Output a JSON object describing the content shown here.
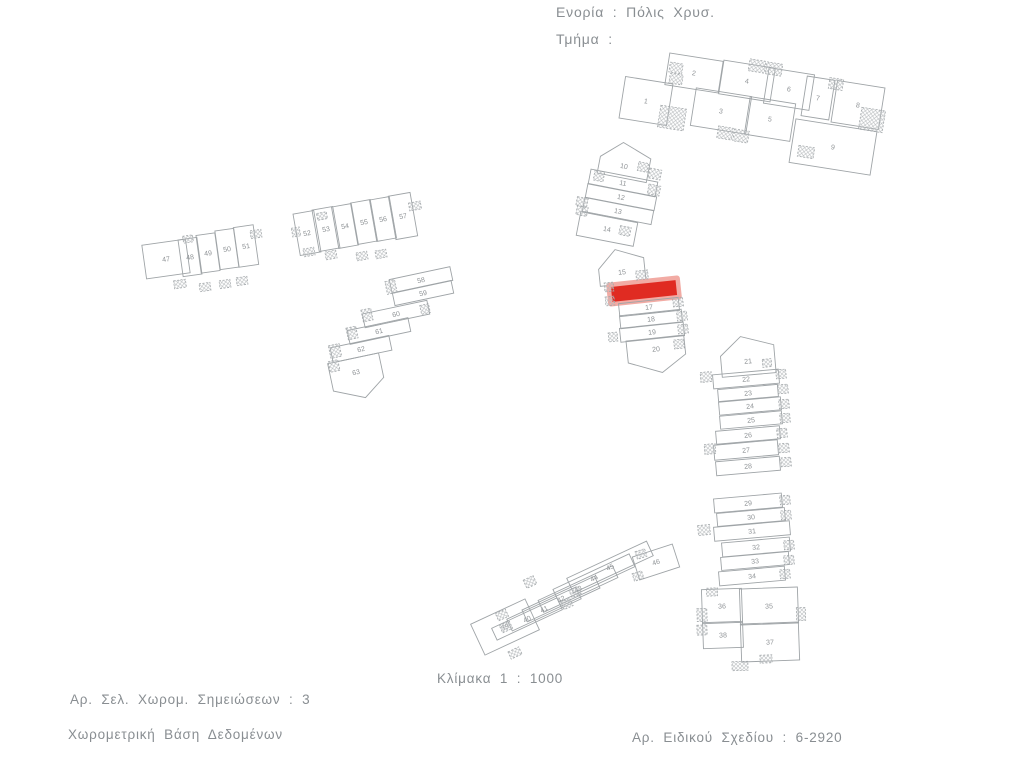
{
  "header": {
    "parish": "Ενορία : Πόλις Χρυσ.",
    "section": "Τμήμα :"
  },
  "footer": {
    "scale": "Κλίμακα 1 : 1000",
    "notes_pages": "Αρ. Σελ. Χωρομ. Σημειώσεων : 3",
    "database": "Χωρομετρική Βάση Δεδομένων",
    "plan_number": "Αρ. Ειδικού Σχεδίου : 6-2920"
  },
  "map": {
    "line_color": "#9fa4a7",
    "label_color": "#8f9396",
    "hatch_color": "#b7bbbd",
    "highlight_color": "#e02b22",
    "highlight_halo": "#f2aba4",
    "clusters": [
      {
        "name": "block-1-9",
        "parcels": [
          {
            "label": "1",
            "cx": 646,
            "cy": 101,
            "w": 48,
            "h": 42,
            "rot": 9
          },
          {
            "label": "2",
            "cx": 694,
            "cy": 73,
            "w": 54,
            "h": 32,
            "rot": 9
          },
          {
            "label": "3",
            "cx": 721,
            "cy": 111,
            "w": 56,
            "h": 38,
            "rot": 9
          },
          {
            "label": "4",
            "cx": 747,
            "cy": 81,
            "w": 52,
            "h": 34,
            "rot": 9
          },
          {
            "label": "5",
            "cx": 770,
            "cy": 119,
            "w": 46,
            "h": 38,
            "rot": 9
          },
          {
            "label": "6",
            "cx": 789,
            "cy": 89,
            "w": 46,
            "h": 36,
            "rot": 9
          },
          {
            "label": "7",
            "cx": 818,
            "cy": 98,
            "w": 28,
            "h": 40,
            "rot": 9
          },
          {
            "label": "8",
            "cx": 858,
            "cy": 105,
            "w": 48,
            "h": 42,
            "rot": 9
          },
          {
            "label": "9",
            "cx": 833,
            "cy": 147,
            "w": 82,
            "h": 44,
            "rot": 9
          }
        ],
        "squares": [
          [
            676,
            68,
            13,
            10,
            9
          ],
          [
            676,
            79,
            13,
            10,
            9
          ],
          [
            757,
            66,
            16,
            12,
            9
          ],
          [
            774,
            69,
            16,
            12,
            9
          ],
          [
            836,
            84,
            14,
            11,
            9
          ],
          [
            672,
            118,
            26,
            22,
            9
          ],
          [
            725,
            133,
            15,
            12,
            9
          ],
          [
            741,
            136,
            15,
            12,
            9
          ],
          [
            872,
            120,
            24,
            22,
            9
          ],
          [
            806,
            152,
            16,
            11,
            9
          ]
        ]
      },
      {
        "name": "block-10-14",
        "parcels": [
          {
            "label": "10",
            "cx": 624,
            "cy": 166,
            "w": 50,
            "h": 24,
            "rot": 11,
            "shape": "pent-up"
          },
          {
            "label": "11",
            "cx": 623,
            "cy": 183,
            "w": 68,
            "h": 15,
            "rot": 11
          },
          {
            "label": "12",
            "cx": 621,
            "cy": 197,
            "w": 70,
            "h": 14,
            "rot": 11
          },
          {
            "label": "13",
            "cx": 618,
            "cy": 211,
            "w": 70,
            "h": 14,
            "rot": 11
          },
          {
            "label": "14",
            "cx": 607,
            "cy": 229,
            "w": 58,
            "h": 24,
            "rot": 11
          }
        ],
        "squares": [
          [
            599,
            176,
            10,
            10,
            11
          ],
          [
            582,
            202,
            11,
            9,
            11
          ],
          [
            582,
            211,
            11,
            9,
            11
          ],
          [
            655,
            174,
            12,
            10,
            11
          ],
          [
            654,
            190,
            12,
            10,
            11
          ],
          [
            643,
            167,
            10,
            9,
            11
          ],
          [
            625,
            231,
            11,
            9,
            11
          ]
        ]
      },
      {
        "name": "block-15-20",
        "parcels": [
          {
            "label": "15",
            "cx": 622,
            "cy": 272,
            "w": 46,
            "h": 24,
            "rot": -6,
            "shape": "pent-up"
          },
          {
            "label": "",
            "cx": 644,
            "cy": 291,
            "w": 64,
            "h": 14,
            "rot": -6,
            "highlight": true
          },
          {
            "label": "17",
            "cx": 649,
            "cy": 307,
            "w": 60,
            "h": 13,
            "rot": -6
          },
          {
            "label": "18",
            "cx": 651,
            "cy": 319,
            "w": 62,
            "h": 13,
            "rot": -6
          },
          {
            "label": "19",
            "cx": 652,
            "cy": 332,
            "w": 64,
            "h": 14,
            "rot": -6
          },
          {
            "label": "20",
            "cx": 656,
            "cy": 349,
            "w": 58,
            "h": 22,
            "rot": -6,
            "shape": "pent-down"
          }
        ],
        "squares": [
          [
            678,
            302,
            10,
            9,
            -6
          ],
          [
            682,
            316,
            10,
            9,
            -6
          ],
          [
            683,
            329,
            10,
            9,
            -6
          ],
          [
            679,
            344,
            10,
            9,
            -6
          ],
          [
            610,
            301,
            9,
            9,
            -6
          ],
          [
            613,
            337,
            9,
            9,
            -6
          ],
          [
            642,
            275,
            12,
            9,
            -6
          ],
          [
            609,
            287,
            9,
            9,
            -6
          ]
        ]
      },
      {
        "name": "block-21-28",
        "parcels": [
          {
            "label": "21",
            "cx": 748,
            "cy": 361,
            "w": 54,
            "h": 28,
            "rot": -5,
            "shape": "pent-up"
          },
          {
            "label": "22",
            "cx": 746,
            "cy": 379,
            "w": 66,
            "h": 14,
            "rot": -5
          },
          {
            "label": "23",
            "cx": 748,
            "cy": 393,
            "w": 60,
            "h": 12,
            "rot": -5
          },
          {
            "label": "24",
            "cx": 750,
            "cy": 406,
            "w": 62,
            "h": 13,
            "rot": -5
          },
          {
            "label": "25",
            "cx": 751,
            "cy": 420,
            "w": 62,
            "h": 13,
            "rot": -5
          },
          {
            "label": "26",
            "cx": 748,
            "cy": 435,
            "w": 64,
            "h": 13,
            "rot": -5
          },
          {
            "label": "27",
            "cx": 746,
            "cy": 450,
            "w": 64,
            "h": 15,
            "rot": -5
          },
          {
            "label": "28",
            "cx": 748,
            "cy": 466,
            "w": 64,
            "h": 14,
            "rot": -5
          }
        ],
        "squares": [
          [
            706,
            377,
            11,
            10,
            -5
          ],
          [
            781,
            374,
            10,
            9,
            -5
          ],
          [
            783,
            389,
            10,
            9,
            -5
          ],
          [
            784,
            404,
            10,
            9,
            -5
          ],
          [
            785,
            418,
            10,
            9,
            -5
          ],
          [
            782,
            433,
            10,
            9,
            -5
          ],
          [
            710,
            449,
            11,
            10,
            -5
          ],
          [
            784,
            448,
            10,
            9,
            -5
          ],
          [
            786,
            462,
            10,
            9,
            -5
          ],
          [
            767,
            363,
            9,
            8,
            -5
          ]
        ]
      },
      {
        "name": "block-29-38",
        "parcels": [
          {
            "label": "29",
            "cx": 748,
            "cy": 503,
            "w": 68,
            "h": 14,
            "rot": -5
          },
          {
            "label": "30",
            "cx": 751,
            "cy": 517,
            "w": 68,
            "h": 13,
            "rot": -5
          },
          {
            "label": "31",
            "cx": 752,
            "cy": 531,
            "w": 76,
            "h": 14,
            "rot": -5
          },
          {
            "label": "32",
            "cx": 756,
            "cy": 547,
            "w": 68,
            "h": 14,
            "rot": -5
          },
          {
            "label": "33",
            "cx": 755,
            "cy": 561,
            "w": 68,
            "h": 13,
            "rot": -5
          },
          {
            "label": "34",
            "cx": 752,
            "cy": 576,
            "w": 66,
            "h": 14,
            "rot": -5
          },
          {
            "label": "36",
            "cx": 722,
            "cy": 606,
            "w": 40,
            "h": 34,
            "rot": -2
          },
          {
            "label": "35",
            "cx": 769,
            "cy": 606,
            "w": 58,
            "h": 36,
            "rot": -2
          },
          {
            "label": "38",
            "cx": 723,
            "cy": 635,
            "w": 40,
            "h": 26,
            "rot": -2
          },
          {
            "label": "37",
            "cx": 770,
            "cy": 642,
            "w": 58,
            "h": 38,
            "rot": -2
          }
        ],
        "squares": [
          [
            785,
            500,
            10,
            9,
            -5
          ],
          [
            786,
            515,
            10,
            9,
            -5
          ],
          [
            704,
            530,
            12,
            10,
            -5
          ],
          [
            789,
            545,
            10,
            9,
            -5
          ],
          [
            789,
            560,
            10,
            9,
            -5
          ],
          [
            785,
            574,
            10,
            9,
            -5
          ],
          [
            702,
            615,
            10,
            13,
            -2
          ],
          [
            801,
            614,
            9,
            13,
            -2
          ],
          [
            702,
            630,
            10,
            10,
            -2
          ],
          [
            712,
            592,
            11,
            8,
            -2
          ],
          [
            766,
            659,
            12,
            8,
            -2
          ],
          [
            740,
            666,
            16,
            9,
            -2
          ]
        ]
      },
      {
        "name": "block-39-46",
        "parcels": [
          {
            "label": "39",
            "cx": 505,
            "cy": 627,
            "w": 60,
            "h": 34,
            "rot": -25
          },
          {
            "label": "40",
            "cx": 527,
            "cy": 619,
            "w": 72,
            "h": 13,
            "rot": -25
          },
          {
            "label": "41",
            "cx": 544,
            "cy": 609,
            "w": 76,
            "h": 13,
            "rot": -25
          },
          {
            "label": "42",
            "cx": 561,
            "cy": 599,
            "w": 80,
            "h": 13,
            "rot": -25
          },
          {
            "label": "43",
            "cx": 578,
            "cy": 589,
            "w": 82,
            "h": 13,
            "rot": -25
          },
          {
            "label": "44",
            "cx": 594,
            "cy": 578,
            "w": 84,
            "h": 14,
            "rot": -25
          },
          {
            "label": "45",
            "cx": 610,
            "cy": 567,
            "w": 88,
            "h": 16,
            "rot": -25
          },
          {
            "label": "46",
            "cx": 656,
            "cy": 562,
            "w": 42,
            "h": 24,
            "rot": -18
          }
        ],
        "squares": [
          [
            502,
            615,
            11,
            8,
            -25
          ],
          [
            506,
            627,
            11,
            8,
            -25
          ],
          [
            530,
            582,
            11,
            9,
            -25
          ],
          [
            567,
            604,
            10,
            8,
            -25
          ],
          [
            575,
            592,
            10,
            8,
            -25
          ],
          [
            641,
            554,
            10,
            8,
            -18
          ],
          [
            638,
            576,
            10,
            8,
            -18
          ],
          [
            515,
            653,
            12,
            8,
            -25
          ]
        ]
      },
      {
        "name": "block-47-51",
        "parcels": [
          {
            "label": "47",
            "cx": 166,
            "cy": 259,
            "w": 44,
            "h": 34,
            "rot": -8
          },
          {
            "label": "48",
            "cx": 190,
            "cy": 257,
            "w": 19,
            "h": 37,
            "rot": -8
          },
          {
            "label": "49",
            "cx": 208,
            "cy": 253,
            "w": 19,
            "h": 38,
            "rot": -8
          },
          {
            "label": "50",
            "cx": 227,
            "cy": 249,
            "w": 19,
            "h": 39,
            "rot": -8
          },
          {
            "label": "51",
            "cx": 246,
            "cy": 246,
            "w": 20,
            "h": 40,
            "rot": -8
          }
        ],
        "squares": [
          [
            180,
            284,
            12,
            8,
            -8
          ],
          [
            205,
            287,
            11,
            8,
            -8
          ],
          [
            225,
            284,
            11,
            8,
            -8
          ],
          [
            242,
            281,
            11,
            8,
            -8
          ],
          [
            188,
            239,
            10,
            7,
            -8
          ],
          [
            256,
            234,
            11,
            8,
            -8
          ]
        ]
      },
      {
        "name": "block-52-57",
        "parcels": [
          {
            "label": "52",
            "cx": 307,
            "cy": 233,
            "w": 21,
            "h": 42,
            "rot": -10
          },
          {
            "label": "53",
            "cx": 326,
            "cy": 229,
            "w": 21,
            "h": 42,
            "rot": -10
          },
          {
            "label": "54",
            "cx": 345,
            "cy": 226,
            "w": 20,
            "h": 42,
            "rot": -10
          },
          {
            "label": "55",
            "cx": 364,
            "cy": 222,
            "w": 20,
            "h": 42,
            "rot": -10
          },
          {
            "label": "56",
            "cx": 383,
            "cy": 219,
            "w": 20,
            "h": 42,
            "rot": -10
          },
          {
            "label": "57",
            "cx": 403,
            "cy": 216,
            "w": 22,
            "h": 44,
            "rot": -10
          }
        ],
        "squares": [
          [
            322,
            216,
            10,
            7,
            -10
          ],
          [
            415,
            206,
            12,
            8,
            -10
          ],
          [
            309,
            252,
            11,
            8,
            -10
          ],
          [
            331,
            255,
            11,
            8,
            -10
          ],
          [
            362,
            256,
            11,
            8,
            -10
          ],
          [
            381,
            254,
            11,
            8,
            -10
          ],
          [
            296,
            232,
            8,
            9,
            -10
          ]
        ]
      },
      {
        "name": "block-58-63",
        "parcels": [
          {
            "label": "58",
            "cx": 421,
            "cy": 280,
            "w": 62,
            "h": 14,
            "rot": -12
          },
          {
            "label": "59",
            "cx": 423,
            "cy": 293,
            "w": 60,
            "h": 13,
            "rot": -12
          },
          {
            "label": "60",
            "cx": 396,
            "cy": 314,
            "w": 66,
            "h": 14,
            "rot": -12
          },
          {
            "label": "61",
            "cx": 379,
            "cy": 331,
            "w": 62,
            "h": 14,
            "rot": -12
          },
          {
            "label": "62",
            "cx": 361,
            "cy": 349,
            "w": 60,
            "h": 15,
            "rot": -12
          },
          {
            "label": "63",
            "cx": 356,
            "cy": 372,
            "w": 52,
            "h": 28,
            "rot": -12,
            "shape": "pent-down"
          }
        ],
        "squares": [
          [
            391,
            287,
            10,
            13,
            -12
          ],
          [
            367,
            315,
            10,
            12,
            -12
          ],
          [
            352,
            333,
            10,
            12,
            -12
          ],
          [
            335,
            351,
            11,
            13,
            -12
          ],
          [
            334,
            366,
            10,
            11,
            -12
          ],
          [
            425,
            309,
            9,
            9,
            -12
          ]
        ]
      }
    ]
  }
}
